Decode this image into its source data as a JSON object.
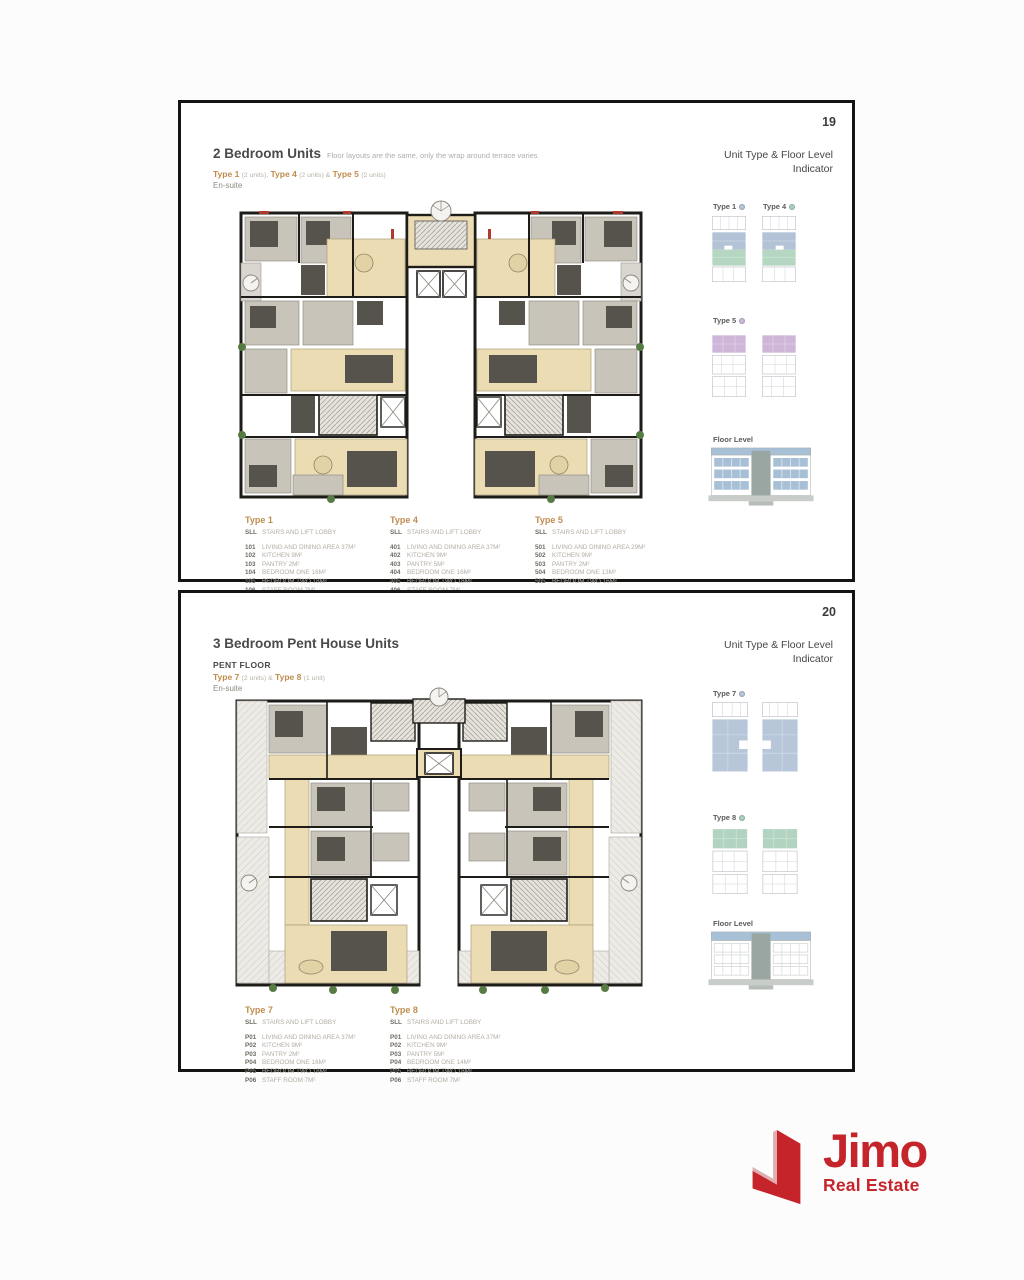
{
  "pages": [
    {
      "number": "19",
      "title": "2 Bedroom Units",
      "title_note": "Floor layouts are the same, only the wrap around terrace varies",
      "type_line": [
        {
          "name": "Type 1",
          "count": "(2 units),"
        },
        {
          "name": "Type 4",
          "count": "(2 units) &"
        },
        {
          "name": "Type 5",
          "count": "(2 units)"
        }
      ],
      "ensuite": "En-suite",
      "sidebar": {
        "heading_line1": "Unit Type & Floor Level",
        "heading_line2": "Indicator",
        "groups": [
          {
            "label": "Type 1"
          },
          {
            "label": "Type 4"
          },
          {
            "label": "Type 5"
          }
        ],
        "floor_level_label": "Floor Level"
      },
      "legend": [
        {
          "name": "Type 1",
          "lobby_code": "SLL",
          "lobby_desc": "STAIRS AND LIFT LOBBY",
          "rooms": [
            {
              "code": "101",
              "desc": "LIVING AND DINING AREA 37M²"
            },
            {
              "code": "102",
              "desc": "KITCHEN 9M²"
            },
            {
              "code": "103",
              "desc": "PANTRY 2M²"
            },
            {
              "code": "104",
              "desc": "BEDROOM ONE 16M²"
            },
            {
              "code": "105",
              "desc": "BEDROOM TWO 18M²"
            },
            {
              "code": "106",
              "desc": "STAFF ROOM 7M²"
            }
          ]
        },
        {
          "name": "Type 4",
          "lobby_code": "SLL",
          "lobby_desc": "STAIRS AND LIFT LOBBY",
          "rooms": [
            {
              "code": "401",
              "desc": "LIVING AND DINING AREA 37M²"
            },
            {
              "code": "402",
              "desc": "KITCHEN 9M²"
            },
            {
              "code": "403",
              "desc": "PANTRY 5M²"
            },
            {
              "code": "404",
              "desc": "BEDROOM ONE 16M²"
            },
            {
              "code": "405",
              "desc": "BEDROOM TWO 18M²"
            },
            {
              "code": "406",
              "desc": "STAFF ROOM 7M²"
            }
          ]
        },
        {
          "name": "Type 5",
          "lobby_code": "SLL",
          "lobby_desc": "STAIRS AND LIFT LOBBY",
          "rooms": [
            {
              "code": "501",
              "desc": "LIVING AND DINING AREA 29M²"
            },
            {
              "code": "502",
              "desc": "KITCHEN 9M²"
            },
            {
              "code": "503",
              "desc": "PANTRY 2M²"
            },
            {
              "code": "504",
              "desc": "BEDROOM ONE 13M²"
            },
            {
              "code": "505",
              "desc": "BEDROOM TWO 16M²"
            }
          ]
        }
      ]
    },
    {
      "number": "20",
      "title": "3 Bedroom Pent House Units",
      "pent_label": "PENT FLOOR",
      "type_line": [
        {
          "name": "Type 7",
          "count": "(2 units) &"
        },
        {
          "name": "Type 8",
          "count": "(1 unit)"
        }
      ],
      "ensuite": "En-suite",
      "sidebar": {
        "heading_line1": "Unit Type & Floor Level",
        "heading_line2": "Indicator",
        "groups": [
          {
            "label": "Type 7"
          },
          {
            "label": "Type 8"
          }
        ],
        "floor_level_label": "Floor Level"
      },
      "legend": [
        {
          "name": "Type 7",
          "lobby_code": "SLL",
          "lobby_desc": "STAIRS AND LIFT LOBBY",
          "rooms": [
            {
              "code": "P01",
              "desc": "LIVING AND DINING AREA 37M²"
            },
            {
              "code": "P02",
              "desc": "KITCHEN 9M²"
            },
            {
              "code": "P03",
              "desc": "PANTRY 2M²"
            },
            {
              "code": "P04",
              "desc": "BEDROOM ONE 16M²"
            },
            {
              "code": "P05",
              "desc": "BEDROOM TWO 18M²"
            },
            {
              "code": "P06",
              "desc": "STAFF ROOM 7M²"
            }
          ]
        },
        {
          "name": "Type 8",
          "lobby_code": "SLL",
          "lobby_desc": "STAIRS AND LIFT LOBBY",
          "rooms": [
            {
              "code": "P01",
              "desc": "LIVING AND DINING AREA 37M²"
            },
            {
              "code": "P02",
              "desc": "KITCHEN 9M²"
            },
            {
              "code": "P03",
              "desc": "PANTRY 5M²"
            },
            {
              "code": "P04",
              "desc": "BEDROOM ONE 14M²"
            },
            {
              "code": "P05",
              "desc": "BEDROOM TWO 18M²"
            },
            {
              "code": "P06",
              "desc": "STAFF ROOM 7M²"
            }
          ]
        }
      ]
    }
  ],
  "logo": {
    "brand": "Jimo",
    "tagline": "Real Estate"
  },
  "colors": {
    "brand_red": "#c5242b",
    "type_accent": "#bf8c4e",
    "indicator_blue": "#b5c4d8",
    "indicator_green": "#a9d2ba",
    "indicator_purple": "#cdb6d8",
    "plan_wood": "#ecdcb4",
    "plan_gray": "#c8c4ba",
    "plan_dark": "#56524c"
  }
}
